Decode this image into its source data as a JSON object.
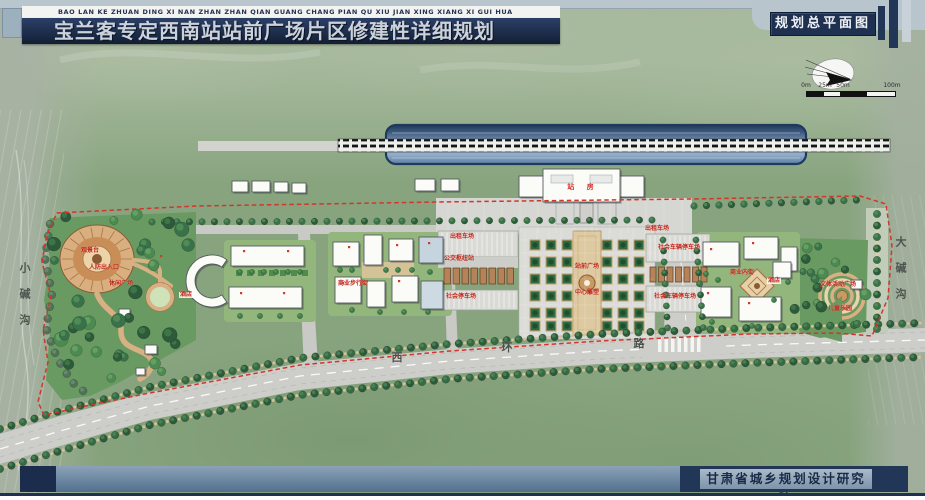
{
  "header": {
    "pinyin": "BAO LAN KE ZHUAN DING XI NAN ZHAN ZHAN QIAN GUANG CHANG PIAN QU XIU JIAN XING  XIANG XI GUI HUA",
    "title": "宝兰客专定西南站站前广场片区修建性详细规划",
    "drawing_label": "规划总平面图"
  },
  "icons": {
    "compass": "north-arrow-compass"
  },
  "scale_bar": {
    "ticks": [
      "0m",
      "25m",
      "50m",
      "100m"
    ]
  },
  "map": {
    "station_label": "站 房",
    "road_name": [
      "西",
      "环",
      "路"
    ],
    "valley_left": "小碱沟",
    "valley_right": "大碱沟",
    "labels": [
      {
        "text": "观景台"
      },
      {
        "text": "人防出入口"
      },
      {
        "text": "休闲广场"
      },
      {
        "text": "酒店"
      },
      {
        "text": "商业步行街"
      },
      {
        "text": "出租车场"
      },
      {
        "text": "公交枢纽站"
      },
      {
        "text": "社会停车场"
      },
      {
        "text": "站前广场"
      },
      {
        "text": "中心雕塑"
      },
      {
        "text": "出租车场"
      },
      {
        "text": "社会车辆停车场"
      },
      {
        "text": "社会车辆停车场"
      },
      {
        "text": "商业内街"
      },
      {
        "text": "酒店"
      },
      {
        "text": "文体活动广场"
      },
      {
        "text": "儿童乐园"
      }
    ]
  },
  "footer": {
    "institute": "甘肃省城乡规划设计研究院"
  }
}
